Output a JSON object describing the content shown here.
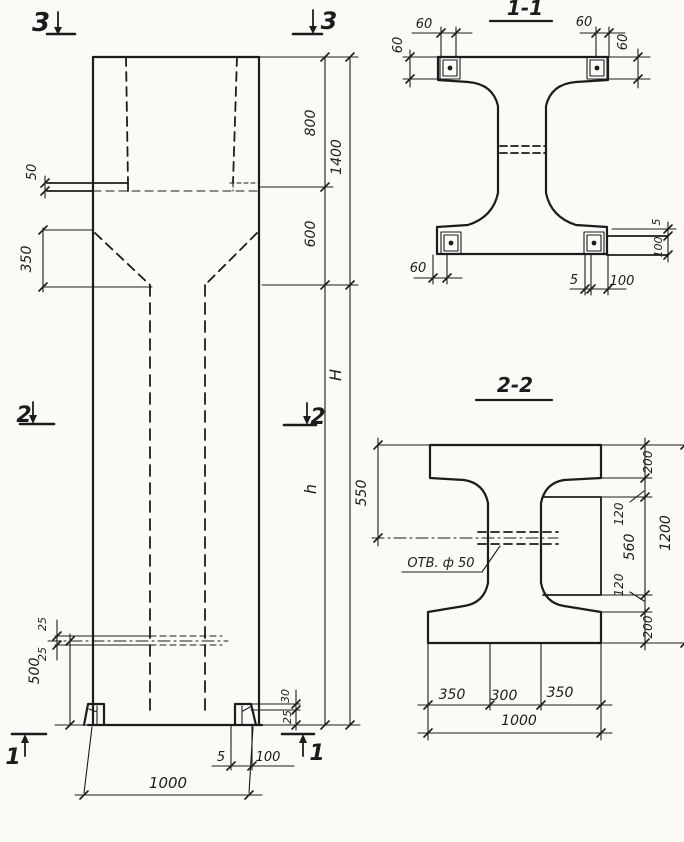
{
  "colors": {
    "paper": "#fbfaf6",
    "ink": "#1c1c1c"
  },
  "views": {
    "elevation": {
      "description": "column elevation view",
      "section_marks": [
        "3",
        "3",
        "2",
        "2",
        "1",
        "1"
      ]
    },
    "section_1_1": {
      "title": "1-1"
    },
    "section_2_2": {
      "title": "2-2",
      "hole_label": "ОТВ. ф 50"
    }
  },
  "labels": [
    {
      "name": "section-mark-3-left",
      "text": "3",
      "x": 41,
      "y": 31,
      "rot": 0,
      "size": 26,
      "w": 700
    },
    {
      "name": "section-mark-3-right",
      "text": "3",
      "x": 329,
      "y": 29,
      "rot": 0,
      "size": 24,
      "w": 700
    },
    {
      "name": "section-mark-2-left",
      "text": "2",
      "x": 24,
      "y": 422,
      "rot": 0,
      "size": 22,
      "w": 700
    },
    {
      "name": "section-mark-2-right",
      "text": "2",
      "x": 318,
      "y": 424,
      "rot": 0,
      "size": 22,
      "w": 700
    },
    {
      "name": "section-mark-1-left",
      "text": "1",
      "x": 13,
      "y": 764,
      "rot": 0,
      "size": 22,
      "w": 700
    },
    {
      "name": "section-mark-1-right",
      "text": "1",
      "x": 317,
      "y": 760,
      "rot": 0,
      "size": 22,
      "w": 700
    },
    {
      "name": "dim-ledge-50",
      "text": "50",
      "x": 36,
      "y": 172,
      "rot": -90,
      "size": 13
    },
    {
      "name": "dim-taper-350",
      "text": "350",
      "x": 31,
      "y": 259,
      "rot": -90,
      "size": 14
    },
    {
      "name": "dim-top-800",
      "text": "800",
      "x": 315,
      "y": 123,
      "rot": -90,
      "size": 14
    },
    {
      "name": "dim-top-1400",
      "text": "1400",
      "x": 341,
      "y": 157,
      "rot": -90,
      "size": 14
    },
    {
      "name": "dim-top-600",
      "text": "600",
      "x": 315,
      "y": 234,
      "rot": -90,
      "size": 14
    },
    {
      "name": "dim-height-H",
      "text": "H",
      "x": 341,
      "y": 375,
      "rot": -90,
      "size": 16
    },
    {
      "name": "dim-height-h",
      "text": "h",
      "x": 316,
      "y": 489,
      "rot": -90,
      "size": 16
    },
    {
      "name": "dim-hole-25-upper",
      "text": "25",
      "x": 46,
      "y": 624,
      "rot": -90,
      "size": 11
    },
    {
      "name": "dim-hole-25-lower",
      "text": "25",
      "x": 46,
      "y": 654,
      "rot": -90,
      "size": 11
    },
    {
      "name": "dim-base-500",
      "text": "500",
      "x": 39,
      "y": 671,
      "rot": -90,
      "size": 14
    },
    {
      "name": "dim-foot-30",
      "text": "30",
      "x": 289,
      "y": 696,
      "rot": -90,
      "size": 11
    },
    {
      "name": "dim-foot-25",
      "text": "25",
      "x": 291,
      "y": 717,
      "rot": -90,
      "size": 11
    },
    {
      "name": "dim-base-5",
      "text": "5",
      "x": 221,
      "y": 761,
      "rot": 0,
      "size": 13
    },
    {
      "name": "dim-base-100",
      "text": "100",
      "x": 268,
      "y": 761,
      "rot": 0,
      "size": 13
    },
    {
      "name": "dim-width-1000",
      "text": "1000",
      "x": 168,
      "y": 788,
      "rot": 0,
      "size": 15
    },
    {
      "name": "section-1-1-title",
      "text": "1-1",
      "x": 525,
      "y": 15,
      "rot": 0,
      "size": 20,
      "w": 700
    },
    {
      "name": "s11-dim-60-top-left",
      "text": "60",
      "x": 424,
      "y": 28,
      "rot": 0,
      "size": 13
    },
    {
      "name": "s11-dim-60-top-right",
      "text": "60",
      "x": 584,
      "y": 26,
      "rot": 0,
      "size": 13
    },
    {
      "name": "s11-dim-60-left",
      "text": "60",
      "x": 402,
      "y": 45,
      "rot": -90,
      "size": 13
    },
    {
      "name": "s11-dim-60-right",
      "text": "60",
      "x": 627,
      "y": 42,
      "rot": -90,
      "size": 13
    },
    {
      "name": "s11-dim-60-bottom-left",
      "text": "60",
      "x": 418,
      "y": 272,
      "rot": 0,
      "size": 13
    },
    {
      "name": "s11-dim-5-bottom-right",
      "text": "5",
      "x": 574,
      "y": 284,
      "rot": 0,
      "size": 13
    },
    {
      "name": "s11-dim-100-bottom-right",
      "text": "100",
      "x": 622,
      "y": 285,
      "rot": 0,
      "size": 13
    },
    {
      "name": "s11-dim-5-right-strip",
      "text": "5",
      "x": 660,
      "y": 222,
      "rot": -90,
      "size": 11
    },
    {
      "name": "s11-dim-100-right-strip",
      "text": "100",
      "x": 662,
      "y": 247,
      "rot": -90,
      "size": 11
    },
    {
      "name": "section-2-2-title",
      "text": "2-2",
      "x": 515,
      "y": 392,
      "rot": 0,
      "size": 20,
      "w": 700
    },
    {
      "name": "s22-dim-550",
      "text": "550",
      "x": 366,
      "y": 493,
      "rot": -90,
      "size": 14
    },
    {
      "name": "s22-hole-label",
      "text": "ОТВ. ф 50",
      "x": 441,
      "y": 567,
      "rot": 0,
      "size": 13
    },
    {
      "name": "s22-dim-120-top",
      "text": "120",
      "x": 623,
      "y": 514,
      "rot": -90,
      "size": 12
    },
    {
      "name": "s22-dim-560",
      "text": "560",
      "x": 634,
      "y": 547,
      "rot": -90,
      "size": 14
    },
    {
      "name": "s22-dim-120-bottom",
      "text": "120",
      "x": 623,
      "y": 585,
      "rot": -90,
      "size": 12
    },
    {
      "name": "s22-dim-200-top",
      "text": "200",
      "x": 652,
      "y": 462,
      "rot": -90,
      "size": 12
    },
    {
      "name": "s22-dim-200-bottom",
      "text": "200",
      "x": 652,
      "y": 627,
      "rot": -90,
      "size": 12
    },
    {
      "name": "s22-dim-1200",
      "text": "1200",
      "x": 670,
      "y": 533,
      "rot": -90,
      "size": 14
    },
    {
      "name": "s22-dim-350-left",
      "text": "350",
      "x": 452,
      "y": 699,
      "rot": 0,
      "size": 14
    },
    {
      "name": "s22-dim-300",
      "text": "300",
      "x": 504,
      "y": 700,
      "rot": 0,
      "size": 14
    },
    {
      "name": "s22-dim-350-right",
      "text": "350",
      "x": 560,
      "y": 697,
      "rot": 0,
      "size": 14
    },
    {
      "name": "s22-dim-1000",
      "text": "1000",
      "x": 519,
      "y": 725,
      "rot": 0,
      "size": 14
    }
  ]
}
